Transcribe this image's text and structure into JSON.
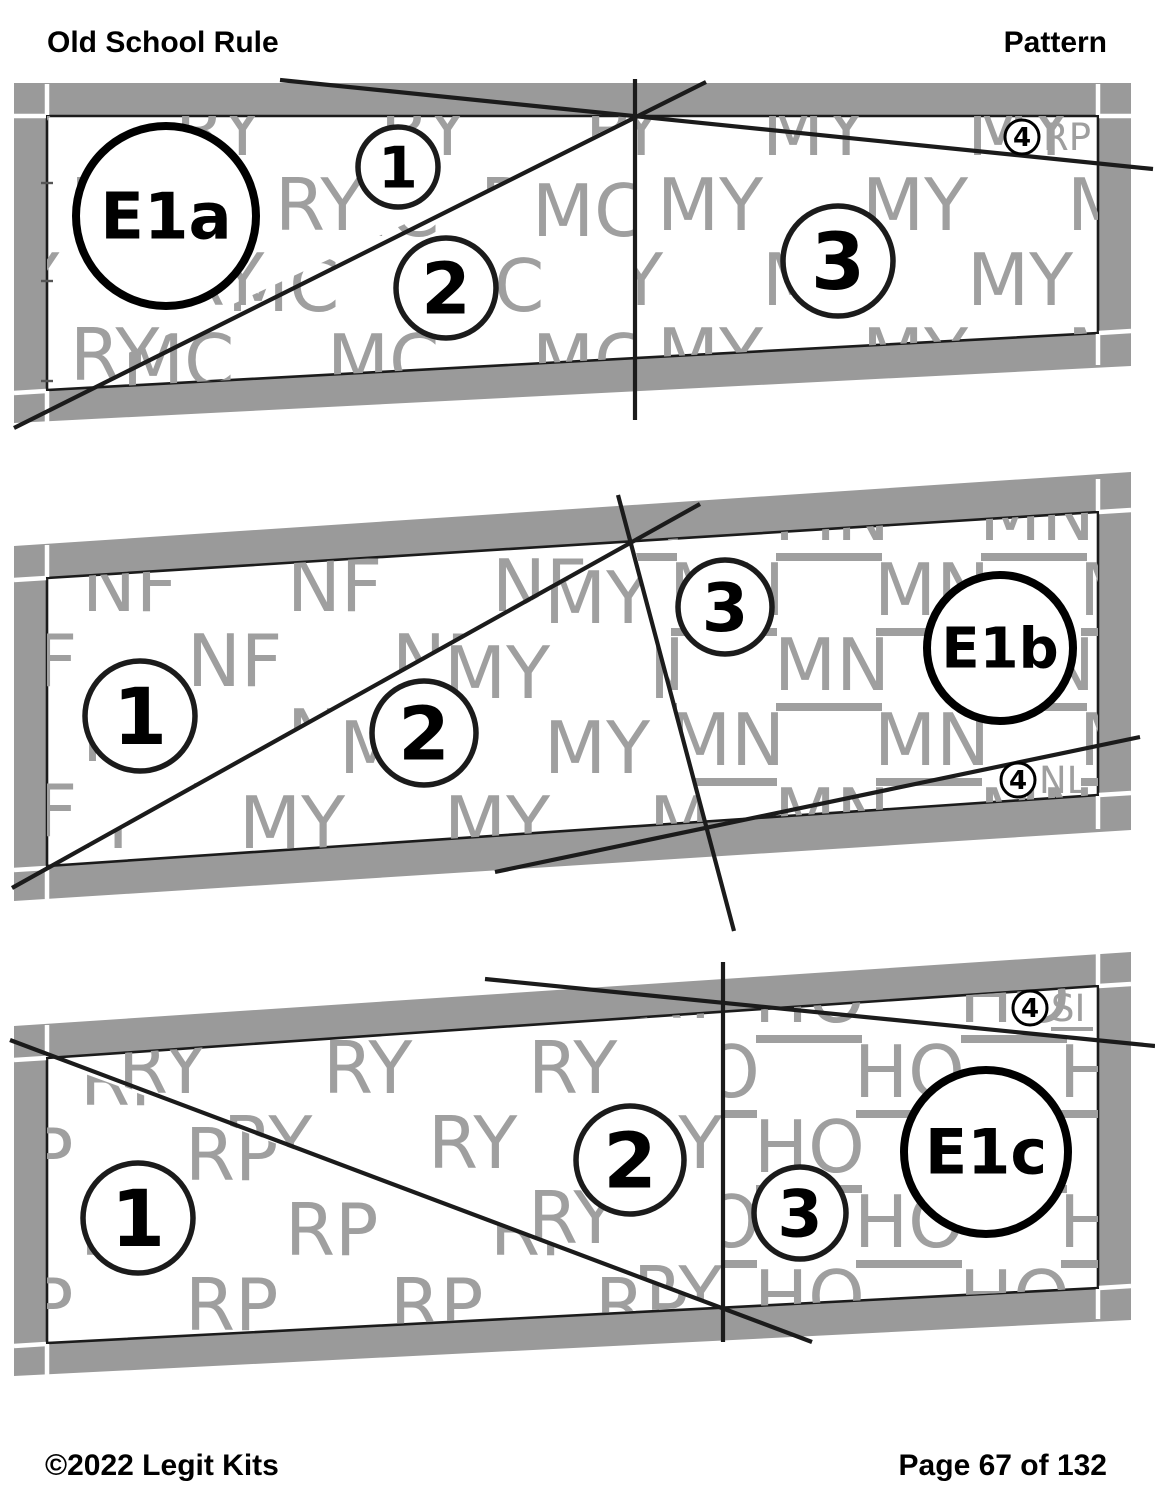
{
  "header": {
    "title": "Old School Rule",
    "label": "Pattern"
  },
  "footer": {
    "copyright": "©2022 Legit Kits",
    "page": "Page 67 of 132"
  },
  "colors": {
    "band": "#9a9a9a",
    "watermark": "#9f9f9f",
    "line": "#1b1b1b"
  },
  "pieces": [
    {
      "label": "E1a",
      "sections": [
        {
          "number": "1",
          "code": "RY",
          "underlined": false
        },
        {
          "number": "2",
          "code": "MC",
          "underlined": false
        },
        {
          "number": "3",
          "code": "MY",
          "underlined": false
        }
      ],
      "corner": {
        "number": "4",
        "code": "RP",
        "underlined": false
      }
    },
    {
      "label": "E1b",
      "sections": [
        {
          "number": "1",
          "code": "NF",
          "underlined": false
        },
        {
          "number": "2",
          "code": "MY",
          "underlined": false
        },
        {
          "number": "3",
          "code": "MN",
          "underlined": true
        }
      ],
      "corner": {
        "number": "4",
        "code": "NL",
        "underlined": false
      }
    },
    {
      "label": "E1c",
      "sections": [
        {
          "number": "1",
          "code": "RP",
          "underlined": false
        },
        {
          "number": "2",
          "code": "RY",
          "underlined": false
        },
        {
          "number": "3",
          "code": "HO",
          "underlined": true
        }
      ],
      "corner": {
        "number": "4",
        "code": "SI",
        "underlined": true
      }
    }
  ]
}
